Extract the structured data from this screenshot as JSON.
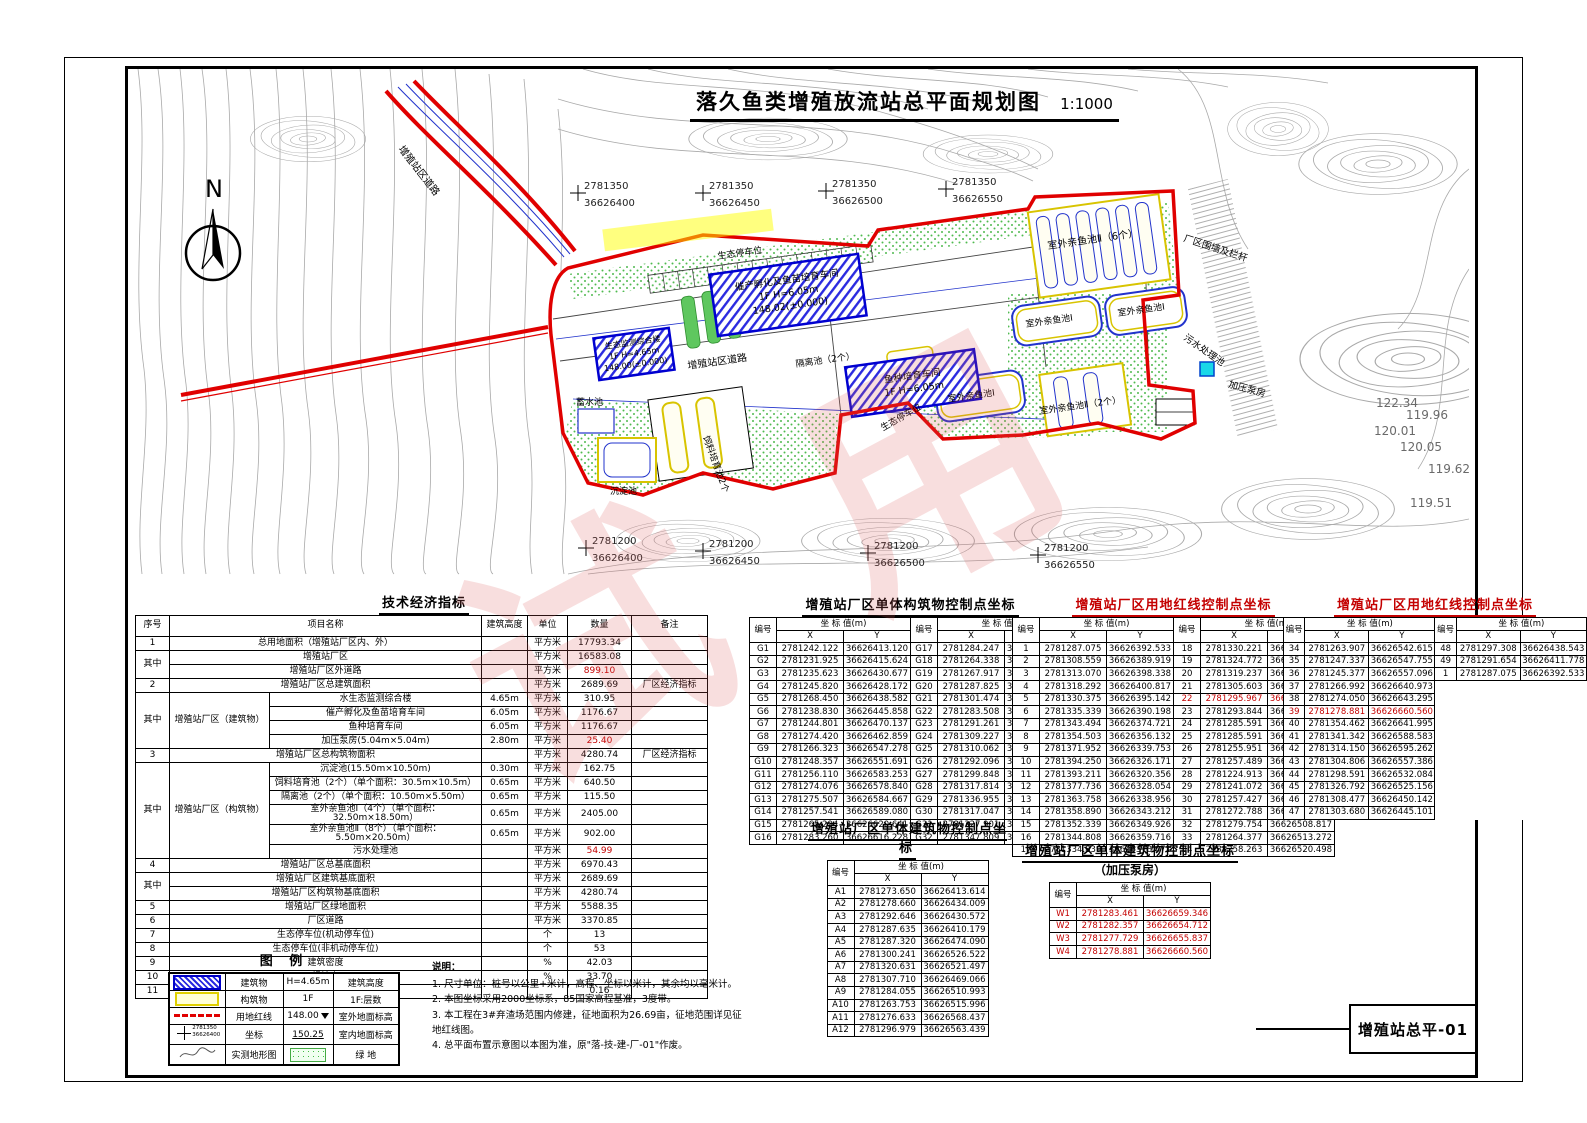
{
  "page": {
    "drawing_number": "增殖站总平-01",
    "watermark": "试用"
  },
  "plan": {
    "title": "落久鱼类增殖放流站总平面规划图",
    "scale": "1:1000",
    "north": "N",
    "grid_top": [
      {
        "x": "2781350",
        "y": "36626400"
      },
      {
        "x": "2781350",
        "y": "36626450"
      },
      {
        "x": "2781350",
        "y": "36626500"
      },
      {
        "x": "2781350",
        "y": "36626550"
      }
    ],
    "grid_bottom": [
      {
        "x": "2781200",
        "y": "36626400"
      },
      {
        "x": "2781200",
        "y": "36626450"
      },
      {
        "x": "2781200",
        "y": "36626500"
      },
      {
        "x": "2781200",
        "y": "36626550"
      }
    ],
    "labels": {
      "hatchery": "催产孵化及鱼苗培育车间",
      "hatchery_sub": "1F  H=6.05m",
      "hatchery_elev": "148.02(±0.000)",
      "fry": "鱼种培育车间",
      "fry_sub": "1F  H=6.05m",
      "monitor": "生态监测综合楼",
      "monitor_sub": "1F  H=4.65m",
      "monitor_elev": "148.00(±0.000)",
      "pond2_6": "室外亲鱼池Ⅱ（6个）",
      "pond1": "室外亲鱼池Ⅰ",
      "pond2_2": "室外亲鱼池Ⅱ（2个）",
      "feed": "饲料培育池2个",
      "sediment": "沉淀池",
      "reservoir": "蓄水池",
      "isolation": "隔离池（2个）",
      "sewage": "污水处理池",
      "pump": "加压泵房",
      "road": "增殖站区道路",
      "parking": "生态停车位",
      "fence": "厂区围墙及栏杆"
    },
    "spots": [
      "122.34",
      "119.96",
      "120.01",
      "120.05",
      "119.62",
      "119.51"
    ]
  },
  "tech_table": {
    "title": "技术经济指标",
    "headers": [
      "序号",
      "项目名称",
      "建筑高度",
      "单位",
      "数量",
      "备注"
    ],
    "rows": [
      {
        "seq": "1",
        "name": "总用地面积（增殖站厂区内、外）",
        "span": "wide",
        "unit": "平方米",
        "qty": "17793.34"
      },
      {
        "seq": "其中",
        "seqspan": 2,
        "name": "增殖站厂区",
        "span": "wide",
        "unit": "平方米",
        "qty": "16583.08"
      },
      {
        "name": "增殖站厂区外道路",
        "span": "wide",
        "unit": "平方米",
        "qty": "899.10",
        "red": true
      },
      {
        "seq": "2",
        "name": "增殖站厂区总建筑面积",
        "span": "wide",
        "unit": "平方米",
        "qty": "2689.69",
        "note": "厂区经济指标"
      },
      {
        "seq": "其中",
        "seqspan": 4,
        "group": "增殖站厂区（建筑物）",
        "groupspan": 4,
        "name": "水生态监测综合楼",
        "height": "4.65m",
        "unit": "平方米",
        "qty": "310.95"
      },
      {
        "name": "催产孵化及鱼苗培育车间",
        "height": "6.05m",
        "unit": "平方米",
        "qty": "1176.67"
      },
      {
        "name": "鱼种培育车间",
        "height": "6.05m",
        "unit": "平方米",
        "qty": "1176.67"
      },
      {
        "name": "加压泵房(5.04m×5.04m)",
        "height": "2.80m",
        "unit": "平方米",
        "qty": "25.40",
        "red": true
      },
      {
        "seq": "3",
        "name": "增殖站厂区总构筑物面积",
        "span": "wide",
        "unit": "平方米",
        "qty": "4280.74",
        "note": "厂区经济指标"
      },
      {
        "seq": "其中",
        "seqspan": 6,
        "group": "增殖站厂区（构筑物）",
        "groupspan": 6,
        "name": "沉淀池(15.50m×10.50m)",
        "height": "0.30m",
        "unit": "平方米",
        "qty": "162.75"
      },
      {
        "name": "饲料培育池（2个）（单个面积：30.5m×10.5m）",
        "height": "0.65m",
        "unit": "平方米",
        "qty": "640.50"
      },
      {
        "name": "隔离池（2个）（单个面积：10.50m×5.50m）",
        "height": "0.65m",
        "unit": "平方米",
        "qty": "115.50"
      },
      {
        "name": "室外亲鱼池Ⅰ（4个）（单个面积：32.50m×18.50m）",
        "height": "0.65m",
        "unit": "平方米",
        "qty": "2405.00"
      },
      {
        "name": "室外亲鱼池Ⅱ（8个）（单个面积：5.50m×20.50m）",
        "height": "0.65m",
        "unit": "平方米",
        "qty": "902.00"
      },
      {
        "name": "污水处理池",
        "unit": "平方米",
        "qty": "54.99",
        "red": true
      },
      {
        "seq": "4",
        "name": "增殖站厂区总基底面积",
        "span": "wide",
        "unit": "平方米",
        "qty": "6970.43"
      },
      {
        "seq": "其中",
        "seqspan": 2,
        "name": "增殖站厂区建筑基底面积",
        "span": "wide",
        "unit": "平方米",
        "qty": "2689.69"
      },
      {
        "name": "增殖站厂区构筑物基底面积",
        "span": "wide",
        "unit": "平方米",
        "qty": "4280.74"
      },
      {
        "seq": "5",
        "name": "增殖站厂区绿地面积",
        "span": "wide",
        "unit": "平方米",
        "qty": "5588.35"
      },
      {
        "seq": "6",
        "name": "厂区道路",
        "span": "wide",
        "unit": "平方米",
        "qty": "3370.85"
      },
      {
        "seq": "7",
        "name": "生态停车位(机动停车位)",
        "span": "wide",
        "unit": "个",
        "qty": "13"
      },
      {
        "seq": "8",
        "name": "生态停车位(非机动停车位)",
        "span": "wide",
        "unit": "个",
        "qty": "53"
      },
      {
        "seq": "9",
        "name": "建筑密度",
        "span": "wide",
        "unit": "%",
        "qty": "42.03"
      },
      {
        "seq": "10",
        "name": "绿地率",
        "span": "wide",
        "unit": "%",
        "qty": "33.70"
      },
      {
        "seq": "11",
        "name": "容积率",
        "span": "wide",
        "unit": "",
        "qty": "0.16"
      }
    ]
  },
  "coord_tables": {
    "hdr": {
      "id": "编号",
      "coord": "坐 标   值(m)",
      "x": "X",
      "y": "Y"
    },
    "g": {
      "title": "增殖站厂区单体构筑物控制点坐标",
      "left": [
        [
          "G1",
          "2781242.122",
          "36626413.120"
        ],
        [
          "G2",
          "2781231.925",
          "36626415.624"
        ],
        [
          "G3",
          "2781235.623",
          "36626430.677"
        ],
        [
          "G4",
          "2781245.820",
          "36626428.172"
        ],
        [
          "G5",
          "2781268.450",
          "36626438.582"
        ],
        [
          "G6",
          "2781238.830",
          "36626445.858"
        ],
        [
          "G7",
          "2781244.801",
          "36626470.137"
        ],
        [
          "G8",
          "2781274.420",
          "36626462.859"
        ],
        [
          "G9",
          "2781266.323",
          "36626547.278"
        ],
        [
          "G10",
          "2781248.357",
          "36626551.691"
        ],
        [
          "G11",
          "2781256.110",
          "36626583.253"
        ],
        [
          "G12",
          "2781274.076",
          "36626578.840"
        ],
        [
          "G13",
          "2781275.507",
          "36626584.667"
        ],
        [
          "G14",
          "2781257.541",
          "36626589.080"
        ],
        [
          "G15",
          "2781265.294",
          "36626620.641"
        ],
        [
          "G16",
          "2781283.260",
          "36626616.228"
        ]
      ],
      "right": [
        [
          "G17",
          "2781284.247",
          "36626620.105"
        ],
        [
          "G18",
          "2781264.338",
          "36626624.995"
        ],
        [
          "G19",
          "2781267.917",
          "36626619.562"
        ],
        [
          "G20",
          "2781287.825",
          "36626634.672"
        ],
        [
          "G21",
          "2781301.474",
          "36626581.385"
        ],
        [
          "G22",
          "2781283.508",
          "36626585.798"
        ],
        [
          "G23",
          "2781291.261",
          "36626617.359"
        ],
        [
          "G24",
          "2781309.227",
          "36626612.946"
        ],
        [
          "G25",
          "2781310.062",
          "36626616.346"
        ],
        [
          "G26",
          "2781292.096",
          "36626620.759"
        ],
        [
          "G27",
          "2781299.848",
          "36626652.321"
        ],
        [
          "G28",
          "2781317.814",
          "36626647.908"
        ],
        [
          "G29",
          "2781336.955",
          "36626593.779"
        ],
        [
          "G30",
          "2781317.047",
          "36626598.669"
        ],
        [
          "G31",
          "2781327.901",
          "36626642.856"
        ],
        [
          "G32",
          "2781347.809",
          "36626637.966"
        ]
      ]
    },
    "r1": {
      "title": "增殖站厂区用地红线控制点坐标",
      "left": [
        [
          "1",
          "2781287.075",
          "36626392.533"
        ],
        [
          "2",
          "2781308.559",
          "36626389.919"
        ],
        [
          "3",
          "2781313.070",
          "36626398.338"
        ],
        [
          "4",
          "2781318.292",
          "36626400.817"
        ],
        [
          "5",
          "2781330.375",
          "36626395.142"
        ],
        [
          "6",
          "2781335.339",
          "36626390.198"
        ],
        [
          "7",
          "2781343.494",
          "36626374.721"
        ],
        [
          "8",
          "2781354.503",
          "36626356.132"
        ],
        [
          "9",
          "2781371.952",
          "36626339.753"
        ],
        [
          "10",
          "2781394.250",
          "36626326.171"
        ],
        [
          "11",
          "2781393.211",
          "36626320.356"
        ],
        [
          "12",
          "2781377.736",
          "36626328.054"
        ],
        [
          "13",
          "2781363.758",
          "36626338.956"
        ],
        [
          "14",
          "2781358.890",
          "36626343.212"
        ],
        [
          "15",
          "2781352.339",
          "36626349.926"
        ],
        [
          "16",
          "2781344.808",
          "36626359.716"
        ],
        [
          "17",
          "2781334.839",
          "36626378.071"
        ]
      ],
      "right": [
        [
          "18",
          "2781330.221",
          "36626386.711"
        ],
        [
          "19",
          "2781324.772",
          "36626392.016"
        ],
        [
          "20",
          "2781319.237",
          "36626393.584"
        ],
        [
          "21",
          "2781305.603",
          "36626383.607"
        ],
        [
          "22",
          "2781295.967",
          "36626385.705",
          true
        ],
        [
          "23",
          "2781293.844",
          "36626384.178"
        ],
        [
          "24",
          "2781285.591",
          "36626386.302"
        ],
        [
          "25",
          "2781285.591",
          "36626386.302"
        ],
        [
          "26",
          "2781255.951",
          "36626393.932"
        ],
        [
          "27",
          "2781257.489",
          "36626399.906"
        ],
        [
          "28",
          "2781224.913",
          "36626408.037"
        ],
        [
          "29",
          "2781241.072",
          "36626473.663"
        ],
        [
          "30",
          "2781257.427",
          "36626478.352"
        ],
        [
          "31",
          "2781272.788",
          "36626480.460"
        ],
        [
          "32",
          "2781279.754",
          "36626508.817"
        ],
        [
          "33",
          "2781264.377",
          "36626513.272"
        ],
        [
          "34",
          "2781258.263",
          "36626520.498"
        ]
      ]
    },
    "r2": {
      "title": "增殖站厂区用地红线控制点坐标",
      "left": [
        [
          "34",
          "2781263.907",
          "36626542.615"
        ],
        [
          "35",
          "2781247.337",
          "36626547.755"
        ],
        [
          "36",
          "2781245.377",
          "36626557.096"
        ],
        [
          "37",
          "2781266.992",
          "36626640.973"
        ],
        [
          "38",
          "2781274.050",
          "36626643.295"
        ],
        [
          "39",
          "2781278.881",
          "36626660.560",
          true
        ],
        [
          "40",
          "2781354.462",
          "36626641.995"
        ],
        [
          "41",
          "2781341.342",
          "36626588.583"
        ],
        [
          "42",
          "2781314.150",
          "36626595.262"
        ],
        [
          "43",
          "2781304.806",
          "36626557.386"
        ],
        [
          "44",
          "2781298.591",
          "36626532.084"
        ],
        [
          "45",
          "2781326.792",
          "36626525.156"
        ],
        [
          "46",
          "2781308.477",
          "36626450.142"
        ],
        [
          "47",
          "2781303.680",
          "36626445.101"
        ]
      ],
      "right": [
        [
          "48",
          "2781297.308",
          "36626438.543"
        ],
        [
          "49",
          "2781291.654",
          "36626411.778"
        ],
        [
          "1",
          "2781287.075",
          "36626392.533"
        ]
      ]
    },
    "a": {
      "title": "增殖站厂区单体建筑物控制点坐标",
      "left": [
        [
          "A1",
          "2781273.650",
          "36626413.614"
        ],
        [
          "A2",
          "2781278.660",
          "36626434.009"
        ],
        [
          "A3",
          "2781292.646",
          "36626430.572"
        ],
        [
          "A4",
          "2781287.635",
          "36626410.179"
        ],
        [
          "A5",
          "2781287.320",
          "36626474.090"
        ],
        [
          "A6",
          "2781300.241",
          "36626526.522"
        ],
        [
          "A7",
          "2781320.631",
          "36626521.497"
        ],
        [
          "A8",
          "2781307.710",
          "36626469.066"
        ],
        [
          "A9",
          "2781284.055",
          "36626510.993"
        ],
        [
          "A10",
          "2781263.753",
          "36626515.996"
        ],
        [
          "A11",
          "2781276.633",
          "36626568.437"
        ],
        [
          "A12",
          "2781296.979",
          "36626563.439"
        ]
      ]
    },
    "w": {
      "title": "增殖站厂区单体建筑物控制点坐标",
      "subtitle": "（加压泵房）",
      "left": [
        [
          "W1",
          "2781283.461",
          "36626659.346",
          true
        ],
        [
          "W2",
          "2781282.357",
          "36626654.712",
          true
        ],
        [
          "W3",
          "2781277.729",
          "36626655.837",
          true
        ],
        [
          "W4",
          "2781278.881",
          "36626660.560",
          true
        ]
      ]
    }
  },
  "legend": {
    "title": "图 例",
    "coord_sample_x": "2781350",
    "coord_sample_y": "36626400",
    "rows": [
      {
        "label": "建筑物",
        "mid": "H=4.65m",
        "right": "建筑高度"
      },
      {
        "label": "构筑物",
        "mid": "1F",
        "right": "1F:层数"
      },
      {
        "label": "用地红线",
        "mid": "148.00",
        "right": "室外地面标高"
      },
      {
        "label": "坐标",
        "mid": "150.25",
        "right": "室内地面标高"
      },
      {
        "label": "实测地形图",
        "mid": "",
        "right": "绿 地"
      }
    ]
  },
  "notes": {
    "title": "说明：",
    "items": [
      "1. 尺寸单位：桩号以公里+米计，高程、坐标以米计，其余均以毫米计。",
      "2. 本图坐标采用2000坐标系，85国家高程基准，3度带。",
      "3. 本工程在3#弃渣场范围内修建，征地面积为26.69亩，征地范围详见征地红线图。",
      "4. 总平面布置示意图以本图为准，原\"落-技-建-厂-01\"作废。"
    ]
  }
}
